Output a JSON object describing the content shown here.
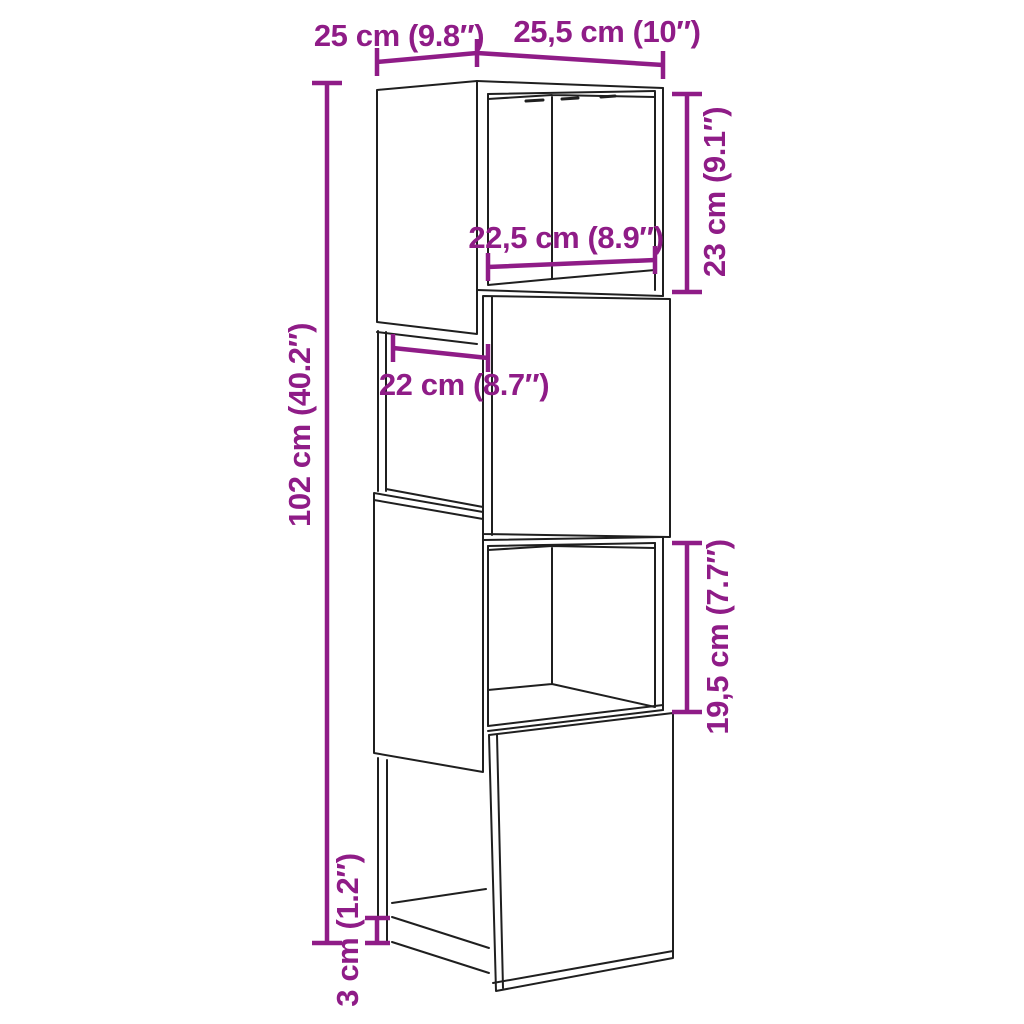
{
  "diagram": {
    "background": "#ffffff",
    "line_color": "#1f1f1f",
    "dimension_color": "#8F1C87",
    "labels": {
      "depth": "25 cm (9.8″)",
      "width": "25,5 cm (10″)",
      "total_height": "102 cm (40.2″)",
      "top_compartment_height": "23 cm (9.1″)",
      "inner_width": "22,5 cm (8.9″)",
      "side_opening_depth": "22 cm (8.7″)",
      "lower_compartment_height": "19,5 cm (7.7″)",
      "plinth_height": "3 cm (1.2″)"
    }
  }
}
